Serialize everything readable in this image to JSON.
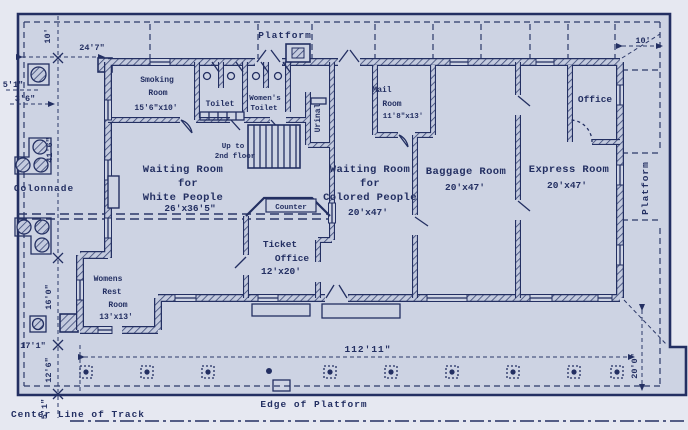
{
  "colors": {
    "paper": "#cdd3e3",
    "paper_outer": "#e6e8f1",
    "ink": "#232f62",
    "hatch": "#3a4775"
  },
  "rooms": {
    "smoking": {
      "line1": "Smoking",
      "line2": "Room",
      "dims": "15'6\"x10'"
    },
    "toilet": {
      "label": "Toilet"
    },
    "womens_toilet": {
      "line1": "Women's",
      "line2": "Toilet"
    },
    "urinal": {
      "label": "Urinal"
    },
    "stair_note": {
      "line1": "Up to",
      "line2": "2nd floor"
    },
    "mail": {
      "line1": "Mail",
      "line2": "Room",
      "dims": "11'8\"x13'"
    },
    "office": {
      "label": "Office"
    },
    "waiting_white": {
      "line1": "Waiting Room",
      "line2": "for",
      "line3": "White People",
      "dims": "26'x36'5\""
    },
    "counter": {
      "label": "Counter"
    },
    "ticket": {
      "line1": "Ticket",
      "line2": "Office",
      "dims": "12'x20'"
    },
    "waiting_colored": {
      "line1": "Waiting Room",
      "line2": "for",
      "line3": "Colored People",
      "dims": "20'x47'"
    },
    "baggage": {
      "line1": "Baggage Room",
      "dims": "20'x47'"
    },
    "express": {
      "line1": "Express Room",
      "dims": "20'x47'"
    },
    "womens_rest": {
      "line1": "Womens",
      "line2": "Rest",
      "line3": "Room",
      "dims": "13'x13'"
    },
    "colonnade": {
      "label": "Colonnade"
    }
  },
  "platform": {
    "top_label": "Platform",
    "right_label": "Platform",
    "edge_label": "Edge of Platform",
    "track_label": "Center Line of Track"
  },
  "dimensions": {
    "platform_depth_top": "10'",
    "approach_width": "24'7\"",
    "column_offset": "5'1\"",
    "column_spacing": "3'6\"",
    "west_wall_length": "41'6\"",
    "womens_wing_depth": "16'0\"",
    "west_platform_width": "17'1\"",
    "south_platform_depth": "12'6\"",
    "track_offset": "5'1\"",
    "building_length": "112'11\"",
    "southeast_platform_depth": "20'0\"",
    "platform_width_right": "10'"
  }
}
